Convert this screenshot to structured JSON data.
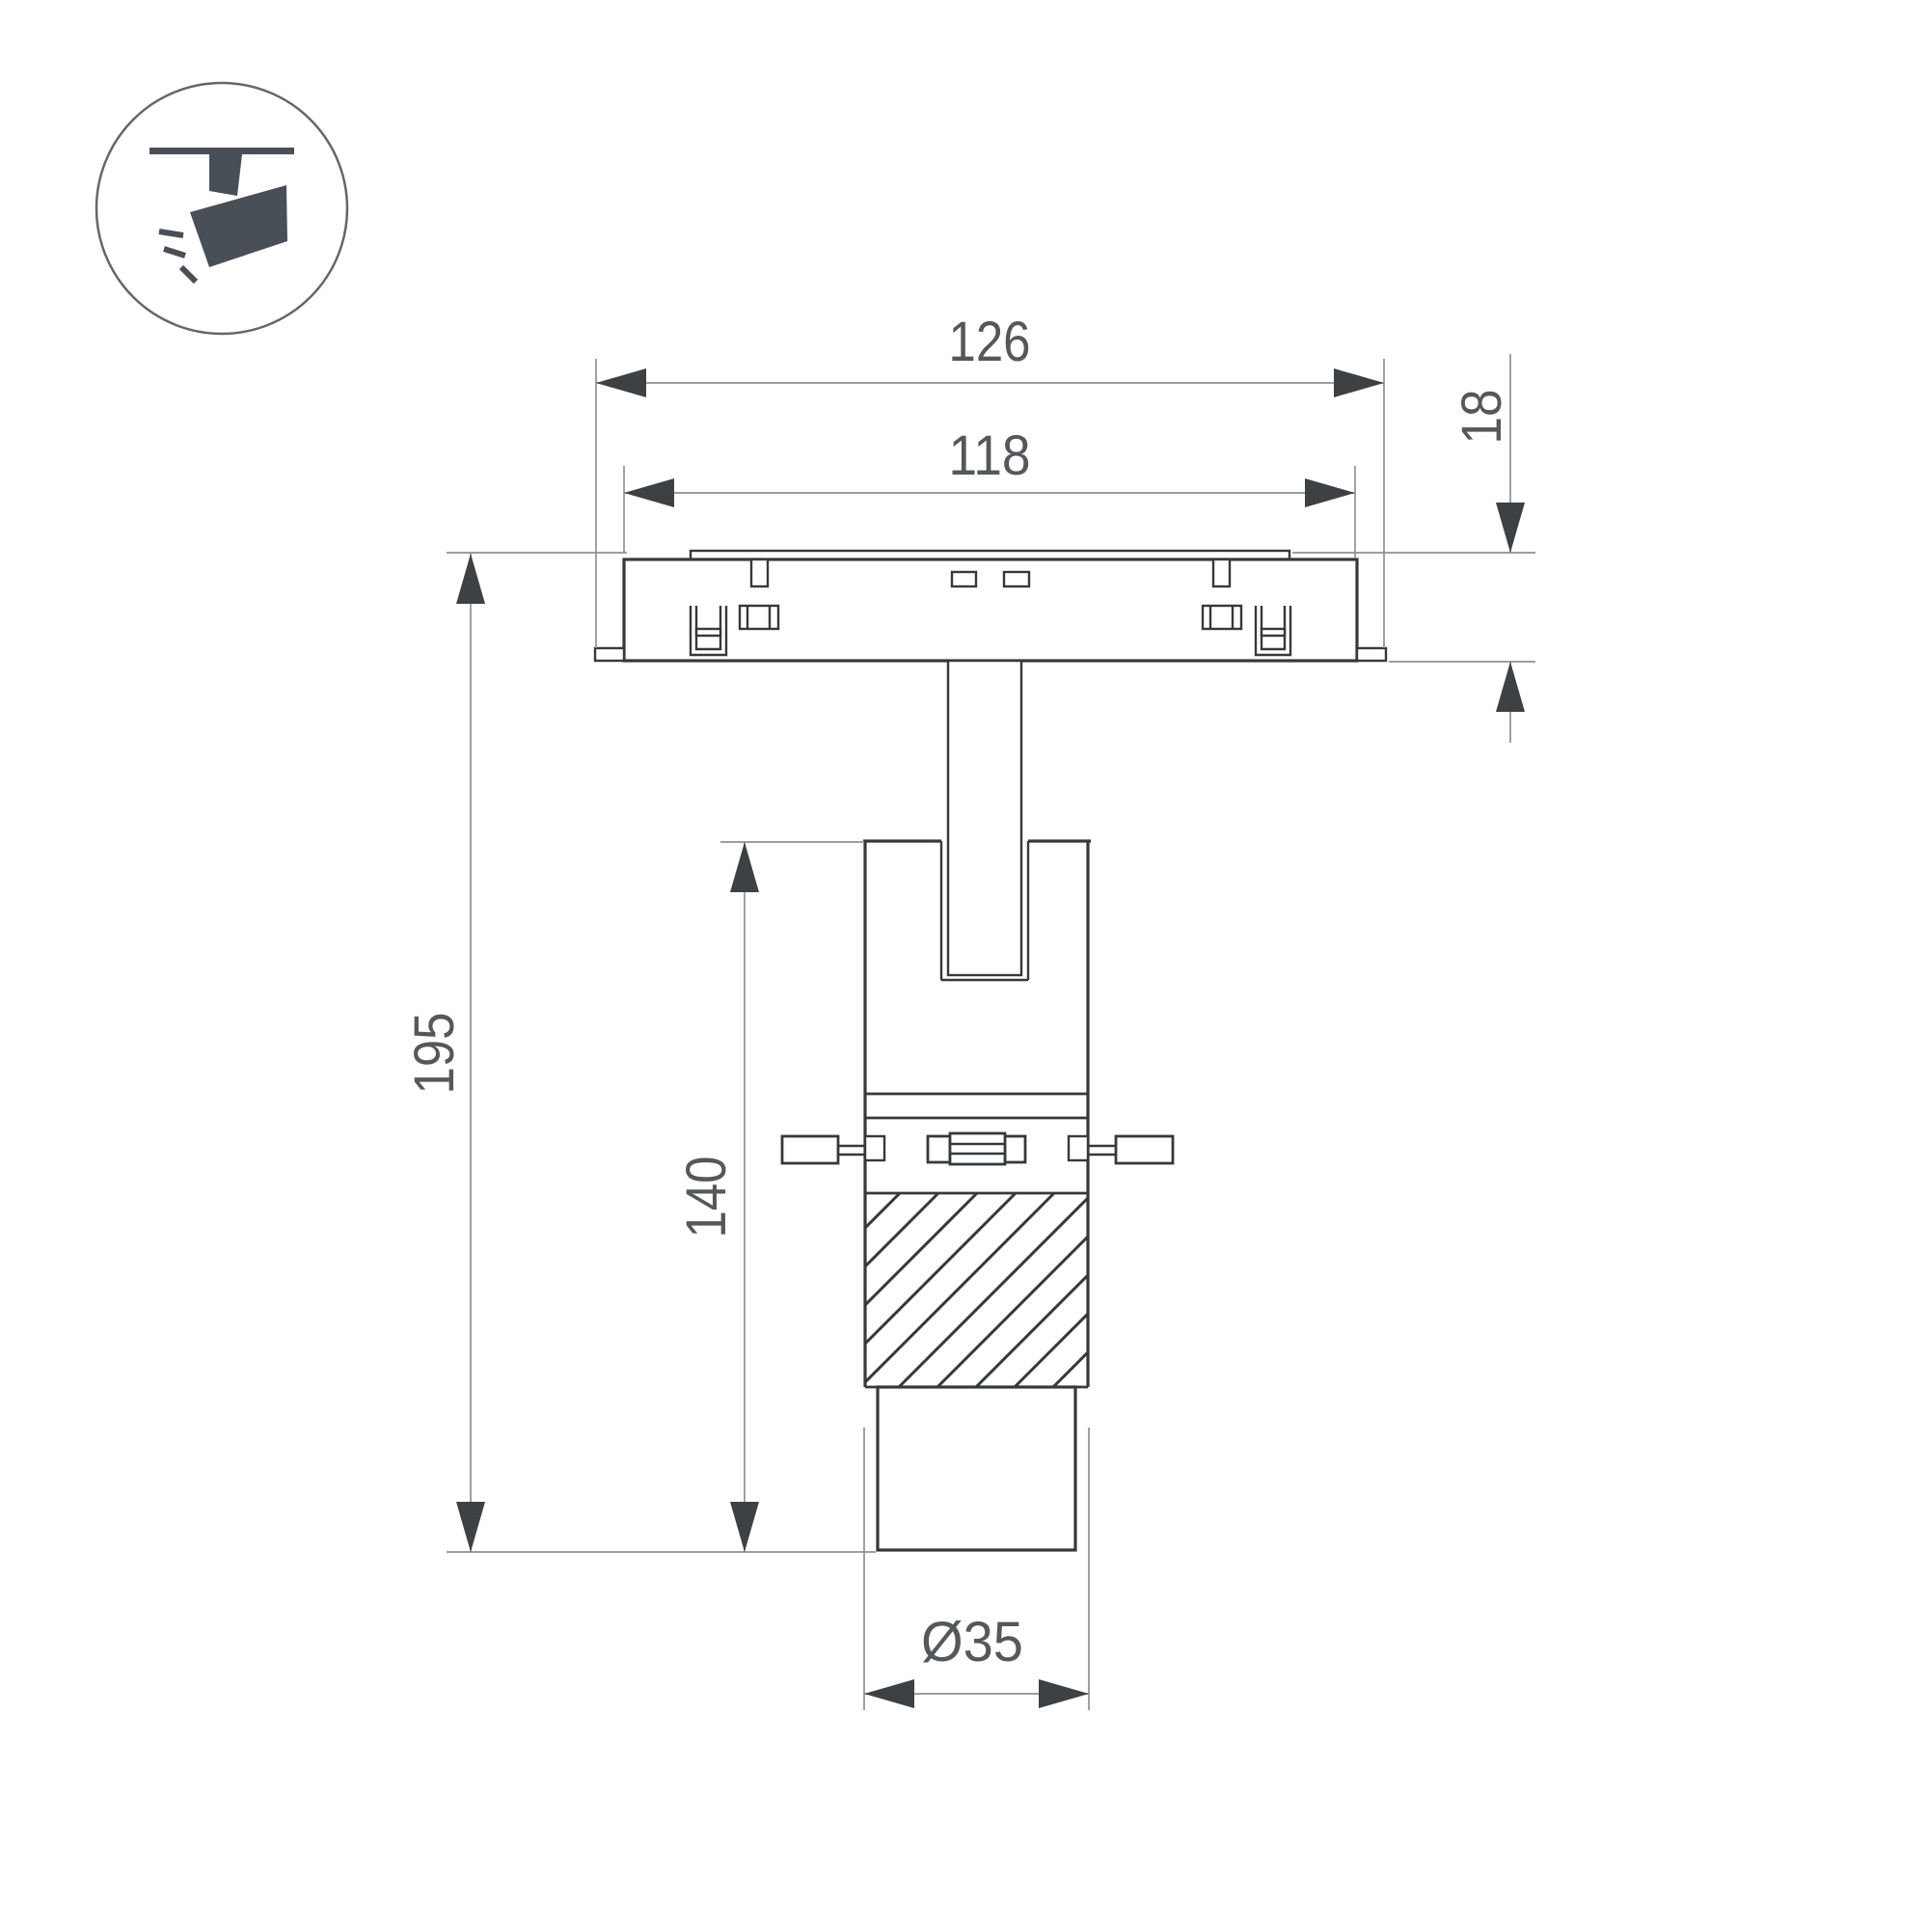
{
  "icon": {
    "name": "track-spotlight-icon"
  },
  "dimensions": {
    "track_width": "126",
    "adapter_width": "118",
    "base_height": "18",
    "total_height": "195",
    "body_height": "140",
    "head_diameter": "Ø35"
  },
  "colors": {
    "line": "#36393c",
    "dim": "#8f9193",
    "arrow": "#3e4144",
    "text": "#55585b",
    "icon": "#494f56",
    "bg": "#ffffff"
  }
}
